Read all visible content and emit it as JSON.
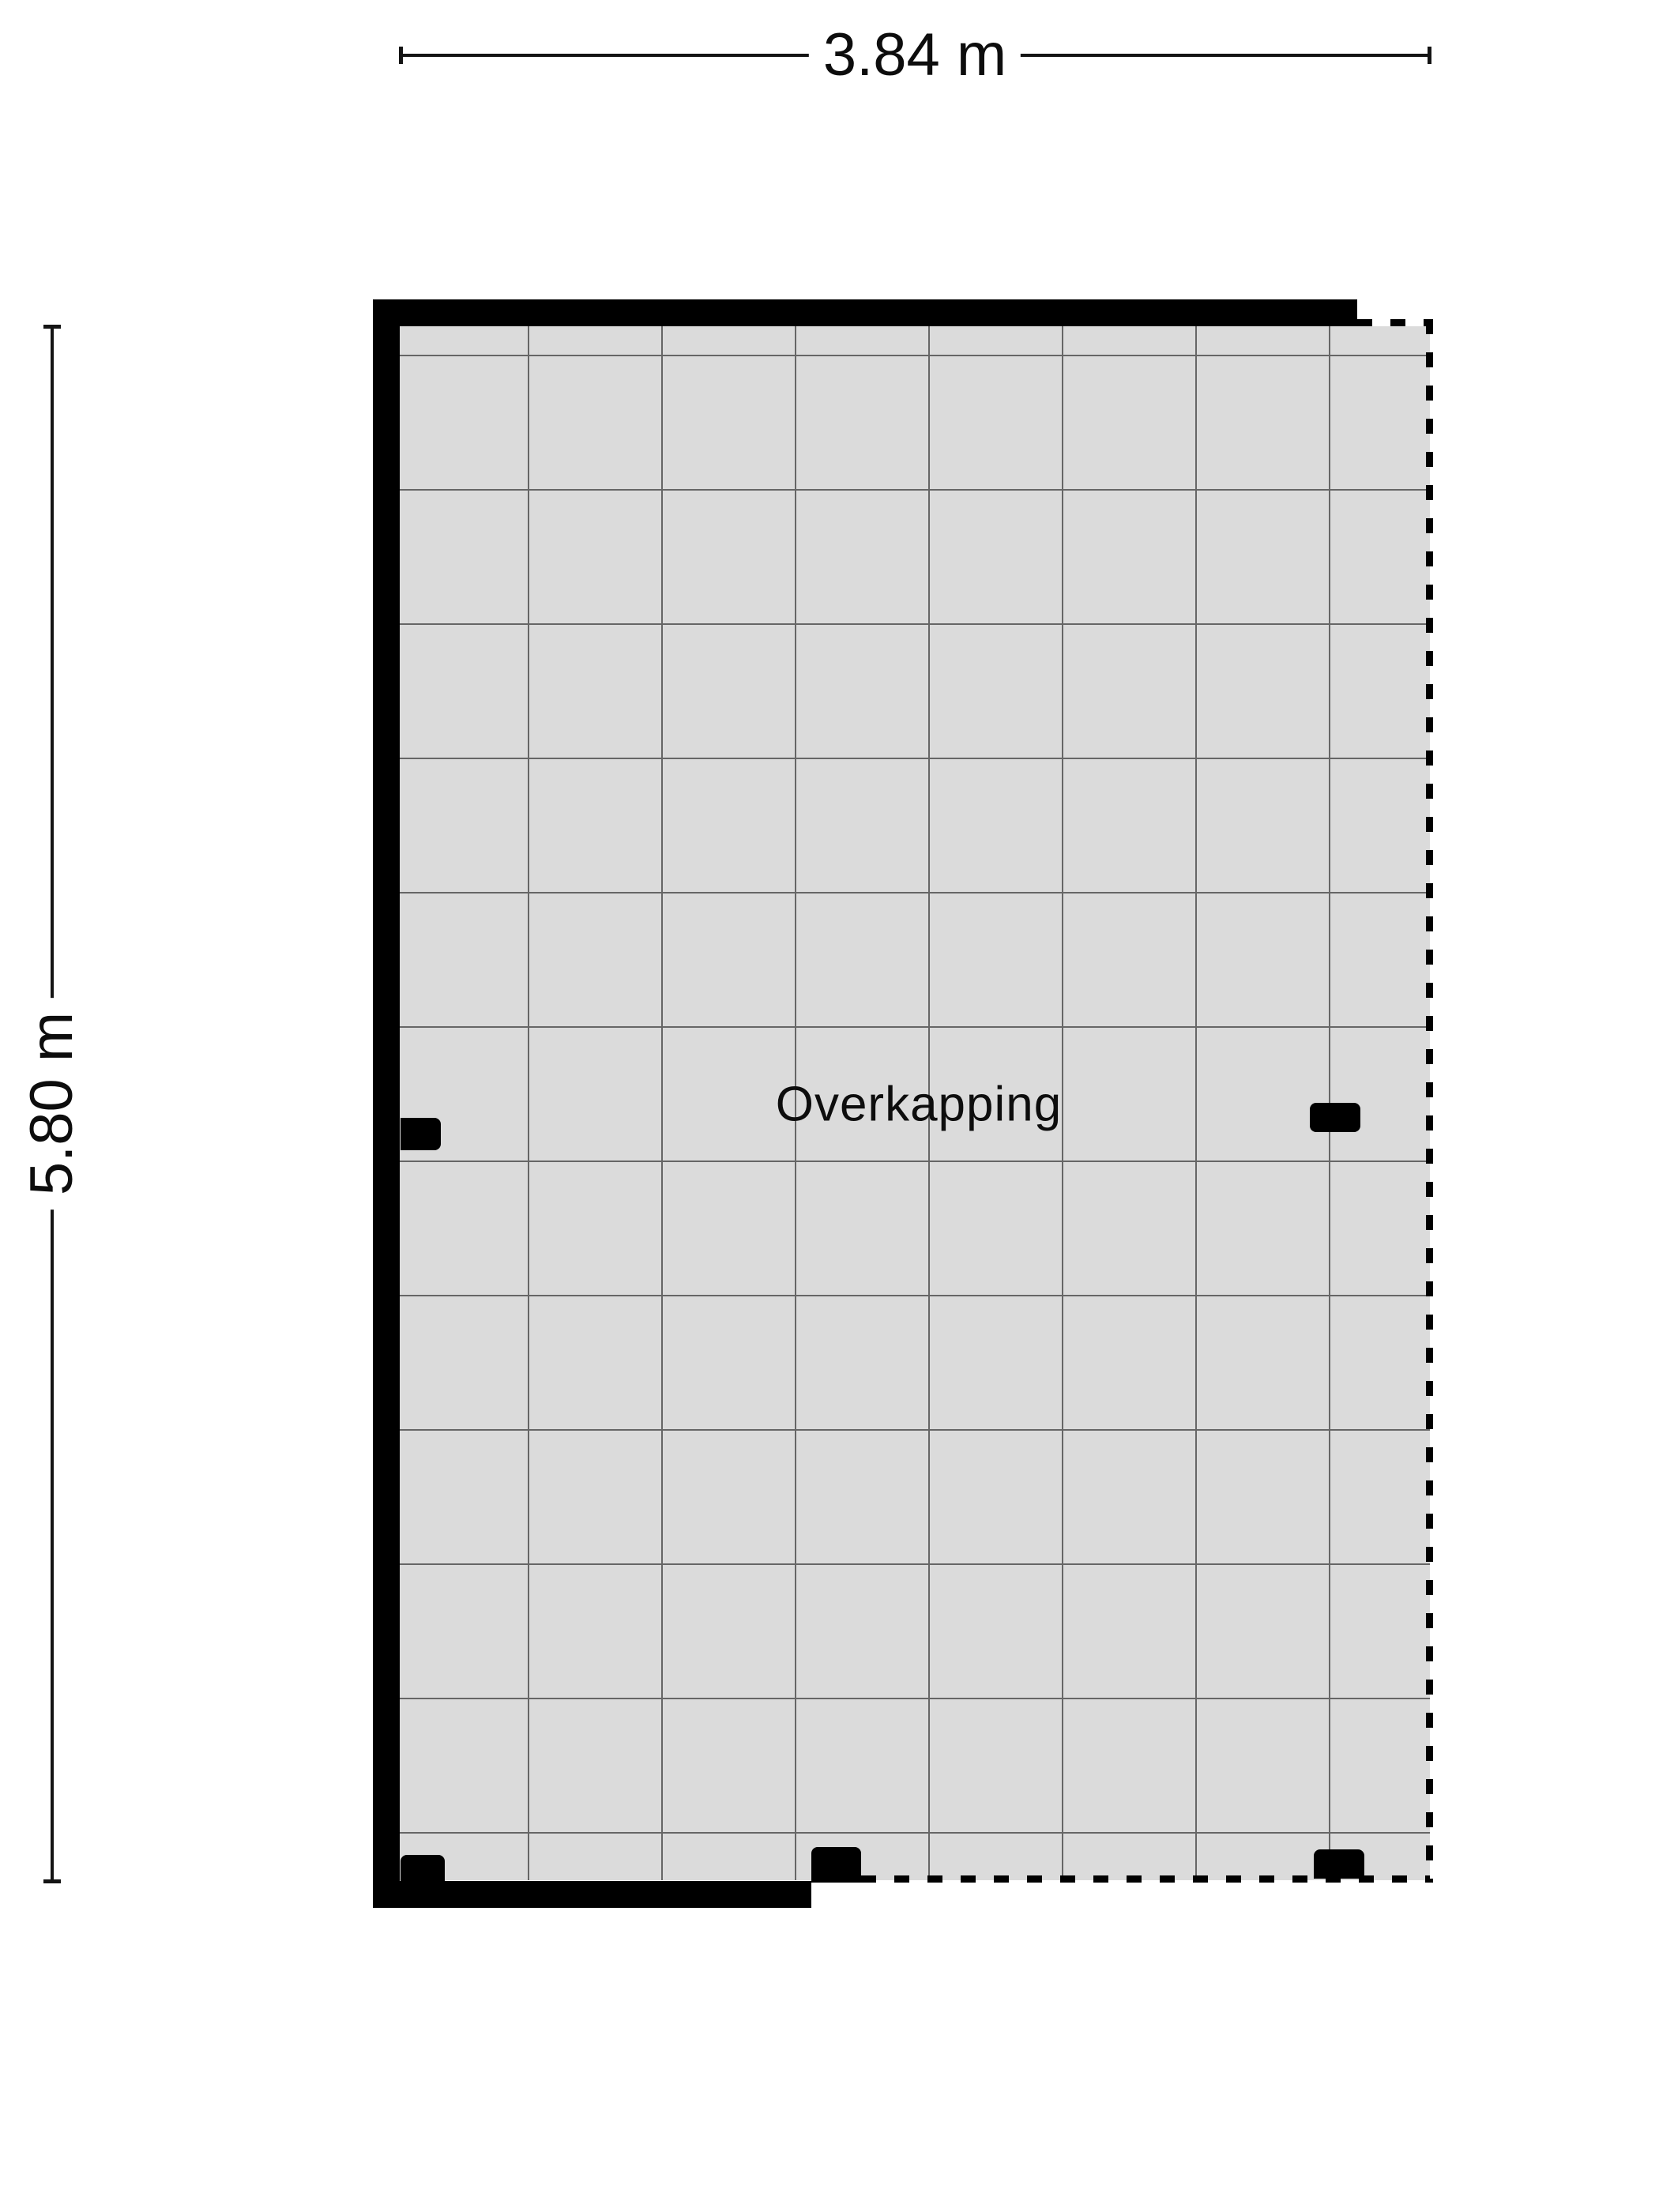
{
  "colors": {
    "background": "#ffffff",
    "floor": "#dbdbdb",
    "grid-line": "#666666",
    "wall": "#000000",
    "dash": "#000000",
    "dim": "#141414",
    "text": "#0d0d0d"
  },
  "room": {
    "label": "Overkapping"
  },
  "dimensions": {
    "top": {
      "label": "3.84 m"
    },
    "left": {
      "label": "5.80 m"
    }
  }
}
